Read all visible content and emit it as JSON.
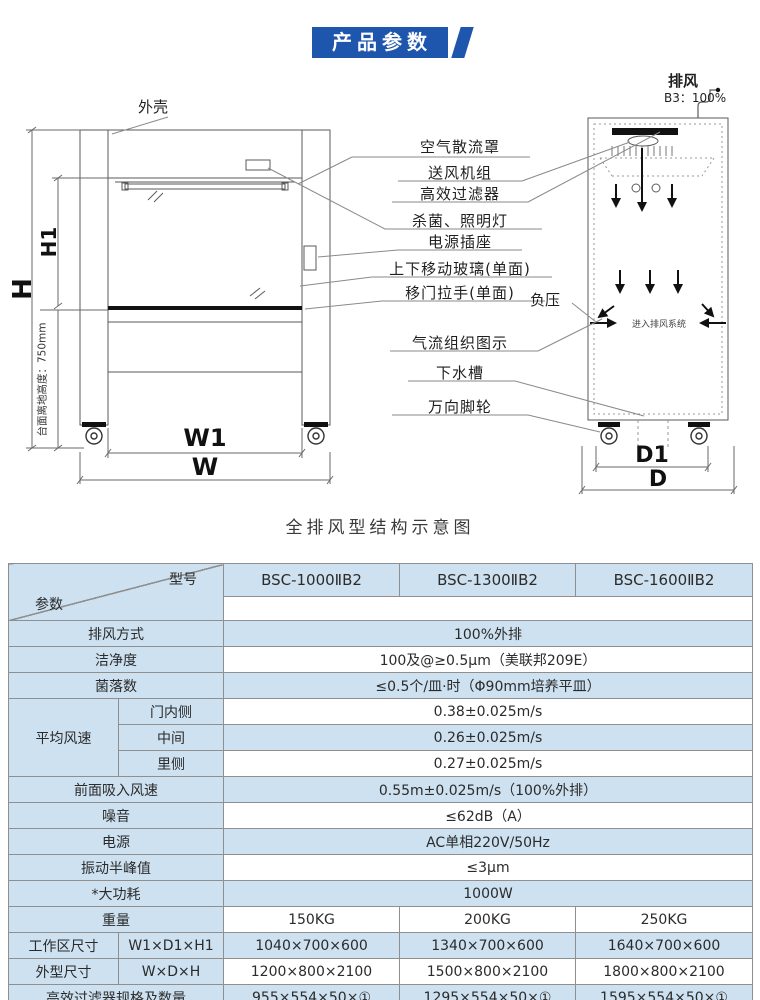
{
  "header": {
    "badge": "产品参数"
  },
  "diagram": {
    "caption": "全排风型结构示意图",
    "shell_label": "外壳",
    "exhaust_label": "排风",
    "exhaust_ratio": "B3：100%",
    "negative_pressure": "负压",
    "duct_note": "进入排风系统",
    "counter_height": "台面离地高度：750mm",
    "dims": {
      "h": "H",
      "h1": "H1",
      "w": "W",
      "w1": "W1",
      "d": "D",
      "d1": "D1"
    },
    "callouts": [
      "空气散流罩",
      "送风机组",
      "高效过滤器",
      "杀菌、照明灯",
      "电源插座",
      "上下移动玻璃(单面)",
      "移门拉手(单面)",
      "气流组织图示",
      "下水槽",
      "万向脚轮"
    ]
  },
  "table": {
    "corner": {
      "model": "型号",
      "param": "参数"
    },
    "models": [
      "BSC-1000ⅡB2",
      "BSC-1300ⅡB2",
      "BSC-1600ⅡB2"
    ],
    "exhaust_mode": {
      "label": "排风方式",
      "value": "100%外排"
    },
    "cleanliness": {
      "label": "洁净度",
      "value": "100及@≥0.5μm（美联邦209E）"
    },
    "colony": {
      "label": "菌落数",
      "value": "≤0.5个/皿·时（Φ90mm培养平皿）"
    },
    "avg_speed": {
      "label": "平均风速",
      "rows": [
        {
          "name": "门内侧",
          "value": "0.38±0.025m/s"
        },
        {
          "name": "中间",
          "value": "0.26±0.025m/s"
        },
        {
          "name": "里侧",
          "value": "0.27±0.025m/s"
        }
      ]
    },
    "front_intake": {
      "label": "前面吸入风速",
      "value": "0.55m±0.025m/s（100%外排）"
    },
    "noise": {
      "label": "噪音",
      "value": "≤62dB（A）"
    },
    "power_supply": {
      "label": "电源",
      "value": "AC单相220V/50Hz"
    },
    "vibration": {
      "label": "振动半峰值",
      "value": "≤3μm"
    },
    "max_power": {
      "label": "*大功耗",
      "value": "1000W"
    },
    "weight": {
      "label": "重量",
      "values": [
        "150KG",
        "200KG",
        "250KG"
      ]
    },
    "work_area": {
      "label": "工作区尺寸",
      "dims": "W1×D1×H1",
      "values": [
        "1040×700×600",
        "1340×700×600",
        "1640×700×600"
      ]
    },
    "overall": {
      "label": "外型尺寸",
      "dims": "W×D×H",
      "values": [
        "1200×800×2100",
        "1500×800×2100",
        "1800×800×2100"
      ]
    },
    "hepa": {
      "label": "高效过滤器规格及数量",
      "values": [
        "955×554×50×①",
        "1295×554×50×①",
        "1595×554×50×①"
      ]
    },
    "lamps": {
      "label": "荧光灯/紫外灯规格及数量",
      "values": [
        "20W×①/20W×①",
        "30W×①/30W×①",
        "30W×①/30W×①"
      ]
    }
  }
}
